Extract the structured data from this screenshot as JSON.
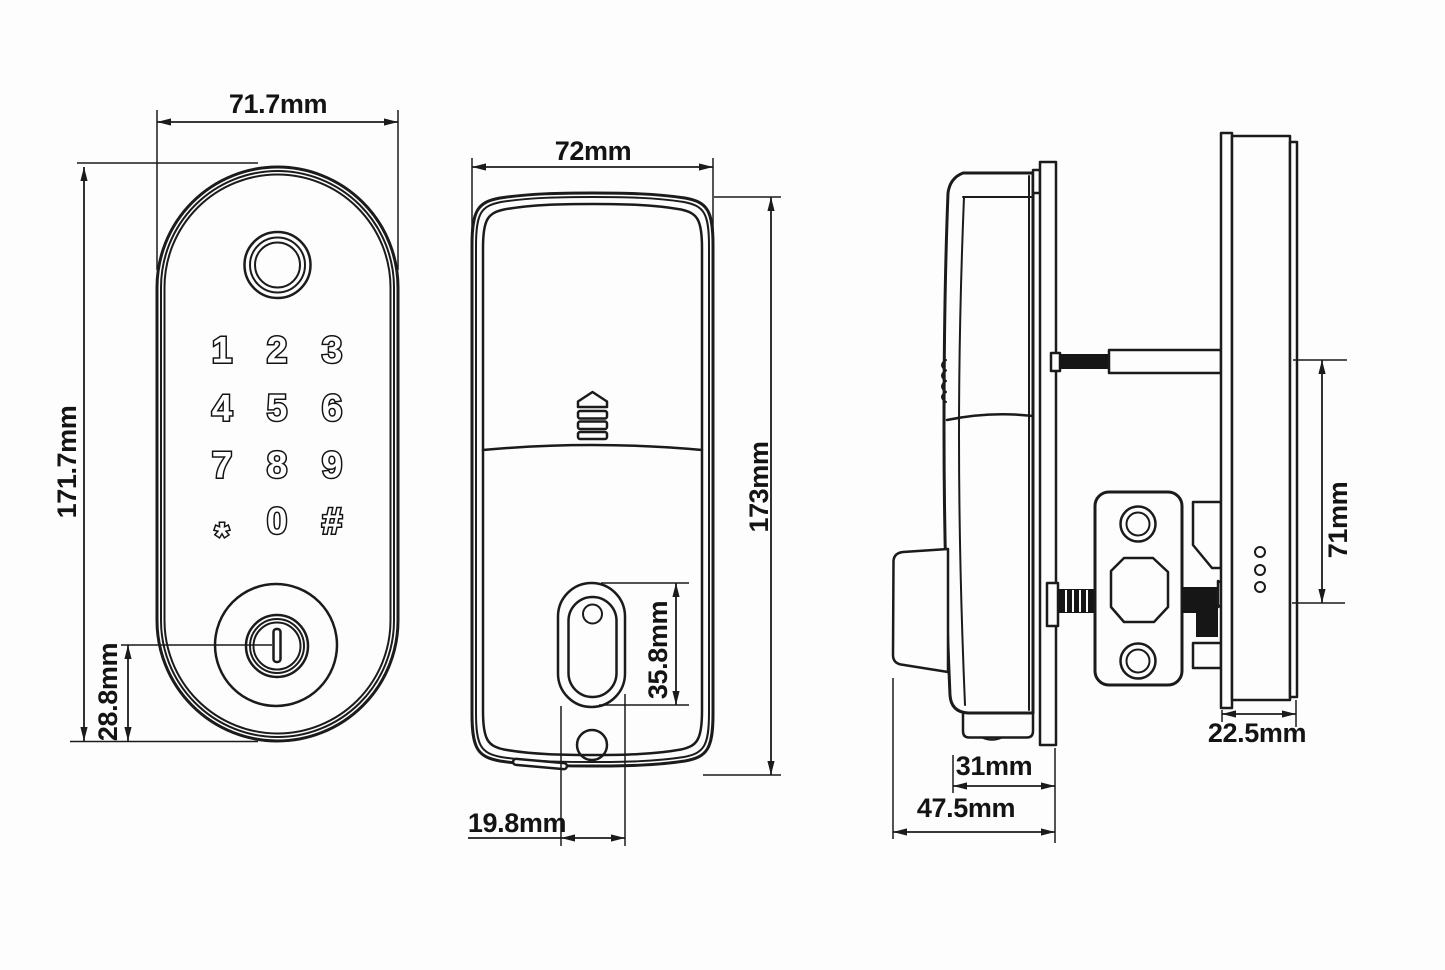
{
  "drawing": {
    "type": "smart-door-lock dimension drawing",
    "line_color": "#1b1b1b",
    "background": "#fdfdfd"
  },
  "front_view": {
    "width_label": "71.7mm",
    "height_label": "171.7mm",
    "keyhole_offset_label": "28.8mm",
    "keypad": {
      "keys": [
        "1",
        "2",
        "3",
        "4",
        "5",
        "6",
        "7",
        "8",
        "9",
        "*",
        "0",
        "#"
      ]
    }
  },
  "back_view": {
    "width_label": "72mm",
    "height_label": "173mm",
    "bolt_oval_height_label": "35.8mm",
    "bolt_oval_width_label": "19.8mm"
  },
  "side_view": {
    "front_body_depth_label": "31mm",
    "total_front_depth_label": "47.5mm",
    "interior_depth_label": "22.5mm",
    "spindle_to_screw_label": "71mm"
  }
}
